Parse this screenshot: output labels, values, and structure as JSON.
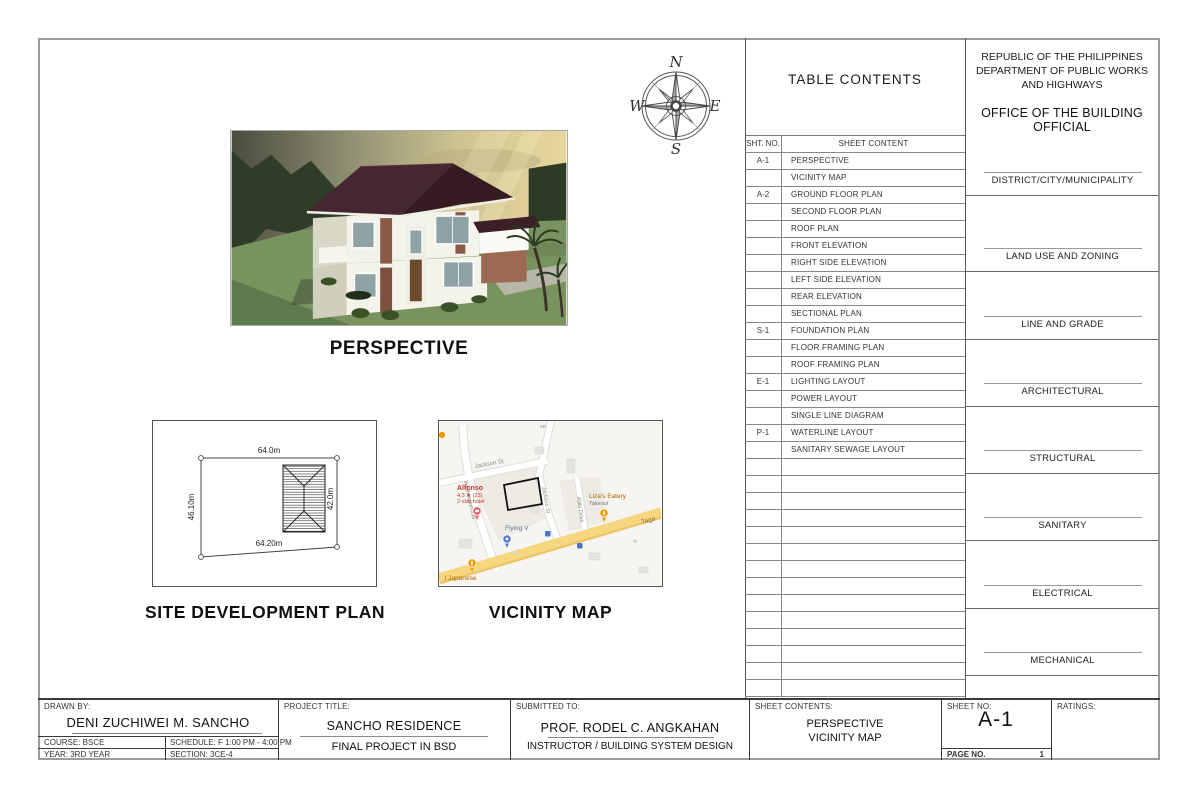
{
  "page": {
    "header_right": {
      "org_lines": [
        "REPUBLIC OF THE PHILIPPINES",
        "DEPARTMENT OF PUBLIC WORKS",
        "AND HIGHWAYS"
      ],
      "office": "OFFICE OF THE BUILDING OFFICIAL",
      "approval_sections": [
        "DISTRICT/CITY/MUNICIPALITY",
        "LAND USE AND ZONING",
        "LINE AND GRADE",
        "ARCHITECTURAL",
        "STRUCTURAL",
        "SANITARY",
        "ELECTRICAL",
        "MECHANICAL"
      ]
    },
    "toc": {
      "title": "TABLE CONTENTS",
      "columns": {
        "sheet_no": "SHT. NO.",
        "sheet_content": "SHEET CONTENT"
      },
      "rows": [
        {
          "no": "A-1",
          "content": "PERSPECTIVE"
        },
        {
          "no": "",
          "content": "VICINITY MAP"
        },
        {
          "no": "A-2",
          "content": "GROUND FLOOR PLAN"
        },
        {
          "no": "",
          "content": "SECOND FLOOR PLAN"
        },
        {
          "no": "",
          "content": "ROOF PLAN"
        },
        {
          "no": "",
          "content": "FRONT ELEVATION"
        },
        {
          "no": "",
          "content": "RIGHT SIDE ELEVATION"
        },
        {
          "no": "",
          "content": "LEFT SIDE ELEVATION"
        },
        {
          "no": "",
          "content": "REAR ELEVATION"
        },
        {
          "no": "",
          "content": "SECTIONAL PLAN"
        },
        {
          "no": "S-1",
          "content": "FOUNDATION PLAN"
        },
        {
          "no": "",
          "content": "FLOOR FRAMING PLAN"
        },
        {
          "no": "",
          "content": "ROOF FRAMING PLAN"
        },
        {
          "no": "E-1",
          "content": "LIGHTING LAYOUT"
        },
        {
          "no": "",
          "content": "POWER LAYOUT"
        },
        {
          "no": "",
          "content": "SINGLE LINE DIAGRAM"
        },
        {
          "no": "P-1",
          "content": "WATERLINE LAYOUT"
        },
        {
          "no": "",
          "content": "SANITARY SEWAGE LAYOUT"
        }
      ],
      "empty_row_count": 14
    },
    "compass": {
      "north": "N",
      "east": "E",
      "south": "S",
      "west": "W"
    },
    "drawings": {
      "perspective_title": "PERSPECTIVE",
      "site_plan_title": "SITE DEVELOPMENT PLAN",
      "vicinity_title": "VICINITY MAP"
    },
    "site_plan": {
      "dim_top": "64.0m",
      "dim_left": "46.10m",
      "dim_right": "42.0m",
      "dim_bottom": "64.20m"
    },
    "vicinity_map": {
      "road_labels": {
        "jackson_h": "Jackson St",
        "jackson_v": "Jackson St",
        "washington": "Washington Ave",
        "alilio": "Alilio Drive",
        "highway": "Taga",
        "fragment": "ve"
      },
      "pois": {
        "alfonso": {
          "name": "Alfonso",
          "rating": "4.3 ★ (23)",
          "type": "2-star hotel"
        },
        "lizas": {
          "name": "Liza's Eatery",
          "type": "Takeout"
        },
        "flying_v": {
          "name": "Flying V"
        },
        "japanese": {
          "name": "l Japanese"
        }
      }
    },
    "title_block": {
      "drawn_by_label": "DRAWN BY:",
      "drawn_by": "DENI ZUCHIWEI M. SANCHO",
      "course": "COURSE: BSCE",
      "schedule": "SCHEDULE: F 1:00 PM - 4:00 PM",
      "year": "YEAR: 3RD YEAR",
      "section": "SECTION: 3CE-4",
      "project_title_label": "PROJECT TITLE:",
      "project_title": "SANCHO RESIDENCE",
      "project_subtitle": "FINAL PROJECT IN BSD",
      "submitted_to_label": "SUBMITTED TO:",
      "submitted_to": "PROF. RODEL C. ANGKAHAN",
      "submitted_to_role": "INSTRUCTOR / BUILDING SYSTEM DESIGN",
      "sheet_contents_label": "SHEET CONTENTS:",
      "sheet_contents_line1": "PERSPECTIVE",
      "sheet_contents_line2": "VICINITY MAP",
      "sheet_no_label": "SHEET NO:",
      "sheet_no": "A-1",
      "page_no_label": "PAGE NO.",
      "page_no": "1",
      "ratings_label": "RATINGS:"
    },
    "colors": {
      "sheet_border": "#9c9c9c",
      "roof_maroon": "#42232c",
      "lawn_green": "#79935f",
      "map_yellow": "#f6d77f",
      "poi_red": "#c0392b",
      "poi_orange": "#f29900",
      "poi_orange_text": "#b06000",
      "poi_blue": "#5b7bd5"
    }
  }
}
